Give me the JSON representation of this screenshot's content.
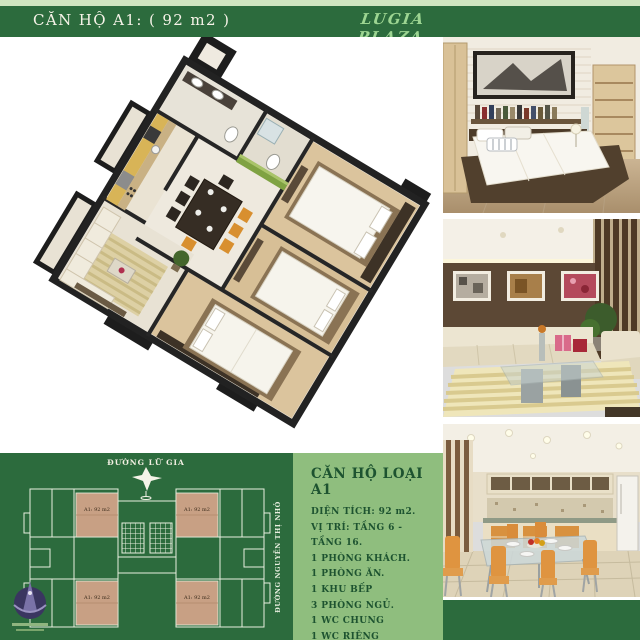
{
  "header": {
    "title": "CĂN HỘ A1: ( 92 m2 )",
    "brand": "LUGIA PLAZA"
  },
  "site_plan": {
    "street_top": "ĐƯỜNG LỮ GIA",
    "street_right": "ĐƯỜNG NGUYỄN THỊ NHỎ",
    "units": [
      {
        "label": "A1: 92 m2"
      },
      {
        "label": "A1: 92 m2"
      },
      {
        "label": "A1: 92 m2"
      },
      {
        "label": "A1: 92 m2"
      }
    ]
  },
  "unit_details": {
    "title": "CĂN HỘ LOẠI A1",
    "lines": [
      "DIỆN TÍCH: 92 m2.",
      "VỊ TRÍ: TẦNG 6 - TẦNG 16.",
      "1 PHÒNG KHÁCH.",
      "1 PHÒNG ĂN.",
      "1 KHU BẾP",
      "3 PHÒNG NGỦ.",
      "1 WC CHUNG",
      "1 WC RIÊNG",
      "1 LO GIA"
    ]
  },
  "photos": [
    {
      "name": "bedroom interior"
    },
    {
      "name": "living room interior"
    },
    {
      "name": "kitchen and dining interior"
    }
  ],
  "colors": {
    "dark_green": "#2c6b3d",
    "pale_green_strip": "#cfe5c0",
    "panel_green": "#8fbe7e",
    "text_green": "#1d5330",
    "brand_green": "#9dd592",
    "unit_tan": "#c8a084"
  }
}
